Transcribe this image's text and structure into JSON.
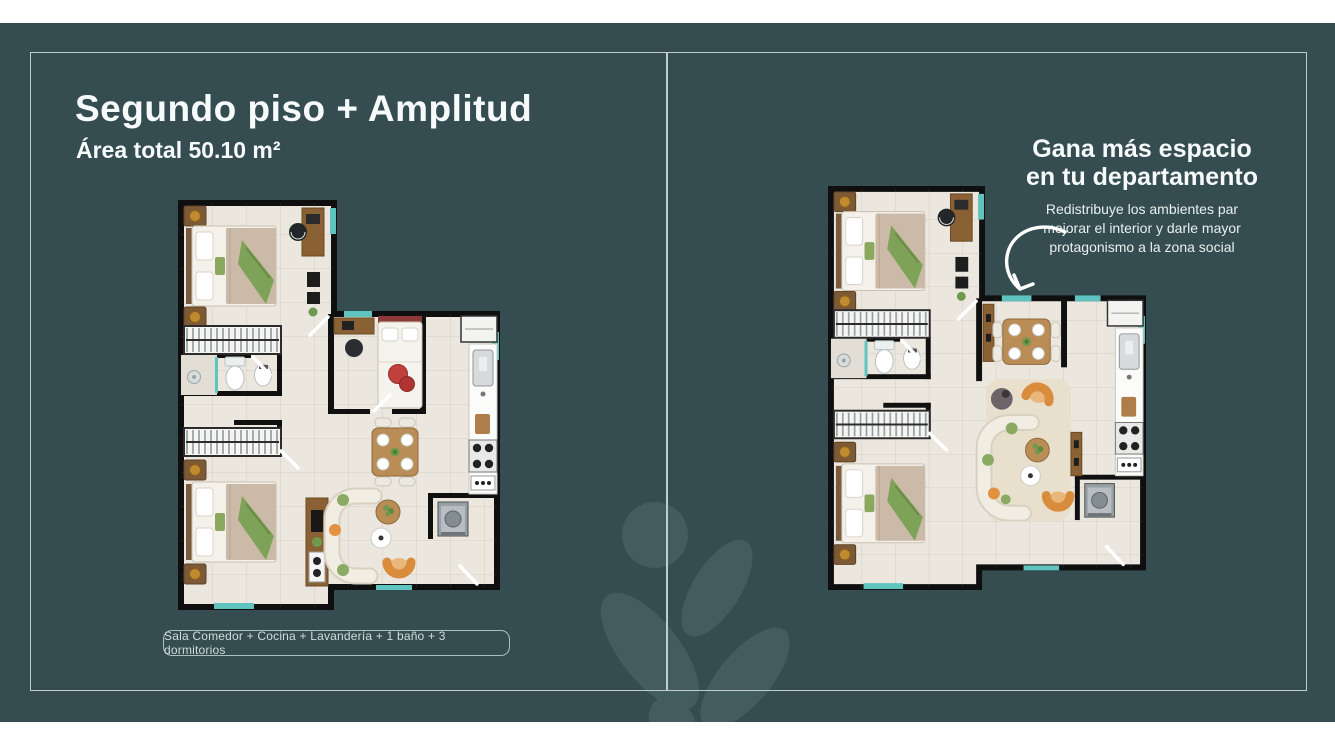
{
  "colors": {
    "background": "#354d51",
    "frame": "#bfcecd",
    "watermark": "#425c60",
    "accent_teal": "#5fc4bf",
    "text": "#f6fafa",
    "muted_text": "#d2dcda"
  },
  "left_panel": {
    "title": "Segundo piso + Amplitud",
    "subtitle": "Área total 50.10 m²",
    "features_badge": "Sala Comedor + Cocina + Lavandería + 1 baño + 3 dormitorios"
  },
  "right_panel": {
    "heading_line1": "Gana más espacio",
    "heading_line2": "en tu departamento",
    "body_line1": "Redistribuye los ambientes par",
    "body_line2": "mejorar el interior y darle mayor",
    "body_line3": "protagonismo a la zona social"
  },
  "icons": {
    "arrow": "curved-arrow-icon",
    "watermark": "plant-leaves-icon",
    "left_plan": "floorplan-original",
    "right_plan": "floorplan-redistributed"
  }
}
